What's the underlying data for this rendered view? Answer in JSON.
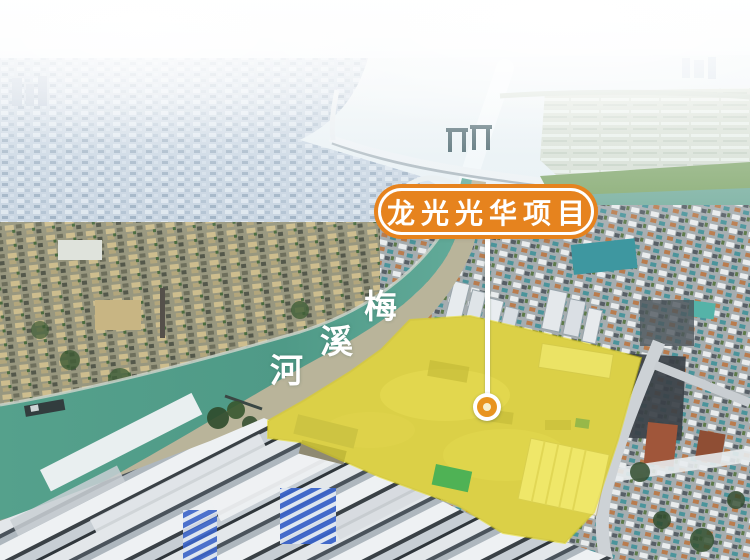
{
  "annotation": {
    "project_label": "龙光光华项目",
    "river_name": "梅溪河",
    "river_chars": [
      "梅",
      "溪",
      "河"
    ]
  },
  "colors": {
    "label_background": "#e6831e",
    "label_border": "#ffffff",
    "label_text": "#ffffff",
    "site_highlight_yellow": "#f3e707",
    "marker_ring_orange": "#e8941f",
    "marker_core": "#f7f0cd",
    "river_teal": "#55a391"
  }
}
